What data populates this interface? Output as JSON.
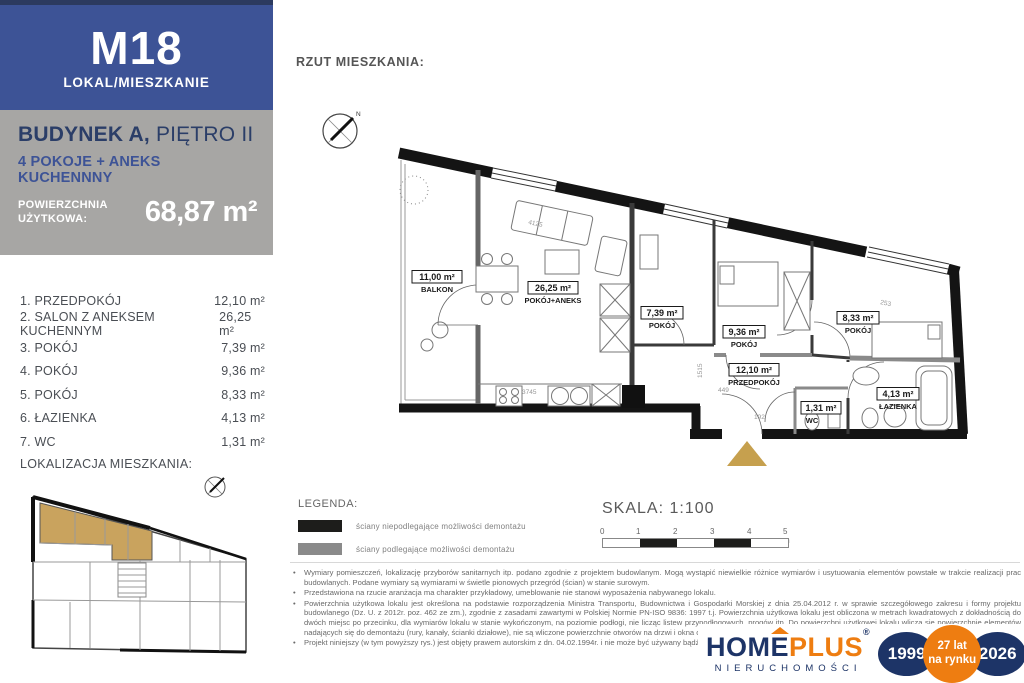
{
  "sidebar": {
    "unit_id": "M18",
    "unit_type_label": "LOKAL/MIESZKANIE",
    "building_bold": "BUDYNEK A,",
    "building_rest": " PIĘTRO II",
    "layout_line": "4 POKOJE + ANEKS KUCHENNNY",
    "area_label": "POWIERZCHNIA UŻYTKOWA:",
    "area_value": "68,87 m²",
    "rooms": [
      {
        "label": "1. PRZEDPOKÓJ",
        "area": "12,10 m²"
      },
      {
        "label": "2. SALON Z ANEKSEM KUCHENNYM",
        "area": "26,25 m²"
      },
      {
        "label": "3. POKÓJ",
        "area": "7,39 m²"
      },
      {
        "label": "4. POKÓJ",
        "area": "9,36 m²"
      },
      {
        "label": "5. POKÓJ",
        "area": "8,33 m²"
      },
      {
        "label": "6. ŁAZIENKA",
        "area": "4,13 m²"
      },
      {
        "label": "7. WC",
        "area": "1,31 m²"
      }
    ],
    "location_label": "LOKALIZACJA MIESZKANIA:",
    "colors": {
      "navy_bar": "#2c3a5f",
      "blue": "#3d5396",
      "gray": "#a7a6a4",
      "highlight_tan": "#c9a35e"
    }
  },
  "main": {
    "title": "RZUT MIESZKANIA:",
    "plan": {
      "compass_north": "N",
      "rooms": [
        {
          "area": "11,00 m²",
          "name": "BALKON"
        },
        {
          "area": "26,25 m²",
          "name": "POKÓJ+ANEKS"
        },
        {
          "area": "7,39 m²",
          "name": "POKÓJ"
        },
        {
          "area": "9,36 m²",
          "name": "POKÓJ"
        },
        {
          "area": "8,33 m²",
          "name": "POKÓJ"
        },
        {
          "area": "12,10 m²",
          "name": "PRZEDPOKÓJ"
        },
        {
          "area": "1,31 m²",
          "name": "WC"
        },
        {
          "area": "4,13 m²",
          "name": "ŁAZIENKA"
        }
      ],
      "dims": [
        "4125",
        "3745",
        "449",
        "1515",
        "253",
        "192"
      ]
    },
    "legend": {
      "title": "LEGENDA:",
      "items": [
        {
          "swatch": "#1d1d1b",
          "label": "ściany niepodlegające możliwości demontażu"
        },
        {
          "swatch": "#8a8a8a",
          "label": "ściany podlegające możliwości demontażu"
        }
      ]
    },
    "scale": {
      "label": "SKALA: 1:100",
      "ticks": [
        "0",
        "1",
        "2",
        "3",
        "4",
        "5 m"
      ]
    },
    "notes_bullet": "•",
    "notes": [
      "Wymiary pomieszczeń, lokalizację przyborów sanitarnych itp. podano zgodnie z projektem budowlanym. Mogą wystąpić niewielkie różnice wymiarów i usytuowania elementów powstałe w trakcie realizacji prac budowlanych. Podane wymiary są wymiarami w świetle pionowych przegród (ścian) w stanie surowym.",
      "Przedstawiona na rzucie aranżacja ma charakter przykładowy, umeblowanie nie stanowi wyposażenia nabywanego lokalu.",
      "Powierzchnia użytkowa lokalu jest określona na podstawie rozporządzenia Ministra Transportu, Budownictwa i Gospodarki Morskiej z dnia 25.04.2012 r. w sprawie szczegółowego zakresu i formy projektu budowlanego (Dz. U. z 2012r. poz. 462 ze zm.), zgodnie z zasadami zawartymi w Polskiej Normie PN-ISO 9836: 1997 t.j. Powierzchnia użytkowa lokalu jest obliczona w metrach kwadratowych z dokładnością do dwóch miejsc po przecinku, dla wymiarów lokalu w stanie wykończonym, na poziomie podłogi, nie licząc listew przypodłogowych, progów itp. Do powierzchni użytkowej lokalu wlicza się powierzchnie elementów nadających się do demontażu (rury, kanały, ścianki działowe), nie są wliczone powierzchnie otworów na drzwi i okna oraz nisze w elementach zamykających.",
      "Projekt niniejszy (w tym powyższy rys.) jest objęty prawem autorskim z dn. 04.02.1994r. i nie może być używany bądź reprodukowany w cało"
    ]
  },
  "footer": {
    "logo": {
      "word_home": "HOM",
      "word_e": "E",
      "word_plus": "PLUS",
      "registered": "®",
      "subtitle": "NIERUCHOMOŚCI",
      "colors": {
        "navy": "#1d3467",
        "orange": "#ee7d11"
      }
    },
    "badges": {
      "year_start": "1999",
      "middle_line1": "27 lat",
      "middle_line2": "na rynku",
      "year_end": "2026"
    }
  }
}
